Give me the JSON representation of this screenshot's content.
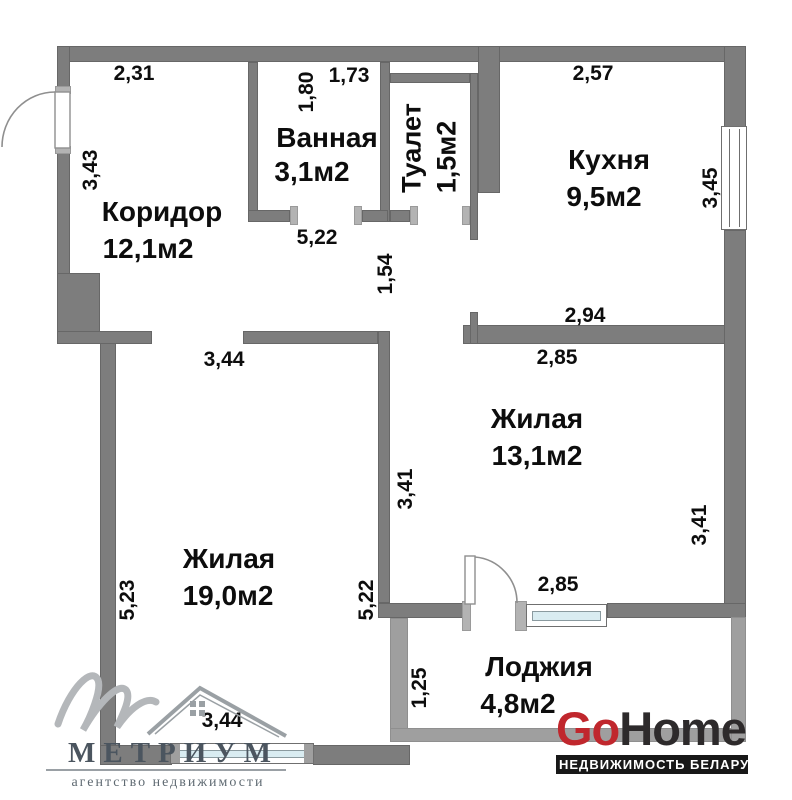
{
  "plan": {
    "rooms": [
      {
        "name": "Коридор",
        "area": "12,1м2"
      },
      {
        "name": "Ванная",
        "area": "3,1м2"
      },
      {
        "name": "Туалет",
        "area": "1,5м2"
      },
      {
        "name": "Кухня",
        "area": "9,5м2"
      },
      {
        "name": "Жилая",
        "area": "13,1м2"
      },
      {
        "name": "Жилая",
        "area": "19,0м2"
      },
      {
        "name": "Лоджия",
        "area": "4,8м2"
      }
    ],
    "dimensions": {
      "corridor_width_top": "2,31",
      "corridor_height_left": "3,43",
      "bath_height_left": "1,80",
      "bath_width_top": "1,73",
      "hall_width_below_bath": "5,22",
      "hall_passage_height": "1,54",
      "kitchen_width_top": "2,57",
      "kitchen_height_right": "3,45",
      "kitchen_width_bottom": "2,94",
      "room19_width_top": "3,44",
      "room13_width_top": "2,85",
      "room13_height_left": "3,41",
      "room13_height_right": "3,41",
      "room19_height_left": "5,23",
      "room19_height_right": "5,22",
      "balcony_door_width": "2,85",
      "loggia_height_left": "1,25",
      "room19_width_bottom": "3,44"
    }
  },
  "watermarks": {
    "metrium": {
      "name": "МЕТРИУМ",
      "tagline": "агентство недвижимости"
    },
    "gohome": {
      "go": "Go",
      "home": "Home",
      "tagline": "НЕДВИЖИМОСТЬ БЕЛАРУСИ"
    }
  },
  "colors": {
    "wall": "#7d7d7d",
    "wall_light": "#9f9f9f",
    "glass": "#d9ecf1",
    "gohome_red": "#c0272d",
    "gohome_dark": "#2d2a2b",
    "metrium_gray": "#4b555f"
  }
}
